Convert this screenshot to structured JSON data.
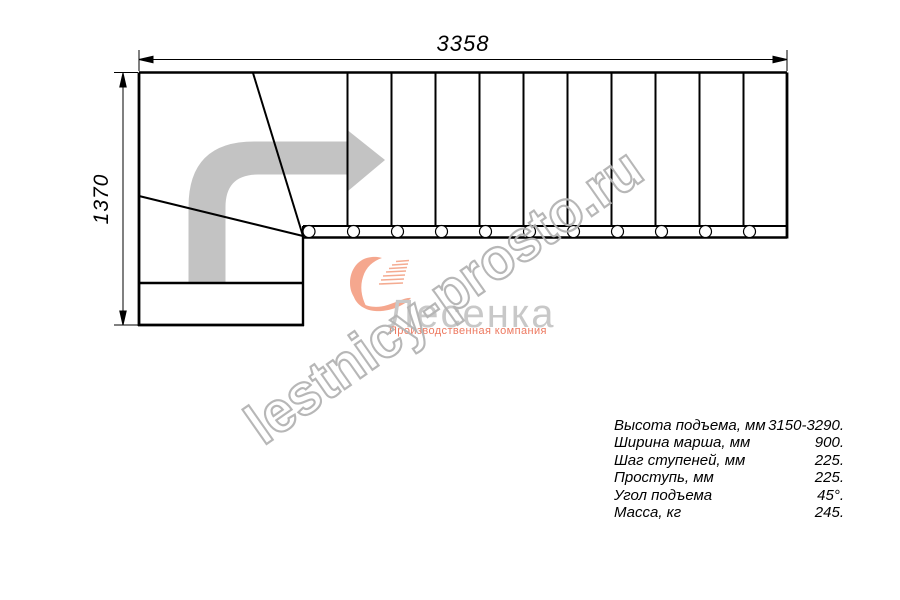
{
  "drawing": {
    "width_label": "3358",
    "height_label": "1370",
    "step_count": 11,
    "type": "staircase-plan-with-lower-winder",
    "line_color": "#000000",
    "arrow_color": "#c3c3c3"
  },
  "watermark": {
    "text": "lestnicy-prosto.ru",
    "color": "#b4b4b4"
  },
  "logo": {
    "name": "Лесенка",
    "tagline": "Производственная компания",
    "name_color": "#c8c8c8",
    "accent_color": "#ed7960",
    "mark_color": "#f5a78e"
  },
  "specs": {
    "rows": [
      {
        "label": "Высота подъема, мм",
        "value": "3150-3290."
      },
      {
        "label": "Ширина марша, мм",
        "value": "900."
      },
      {
        "label": "Шаг ступеней, мм",
        "value": "225."
      },
      {
        "label": "Проступь, мм",
        "value": "225."
      },
      {
        "label": "Угол подъема",
        "value": "45°."
      },
      {
        "label": "Масса, кг",
        "value": "245."
      }
    ]
  }
}
